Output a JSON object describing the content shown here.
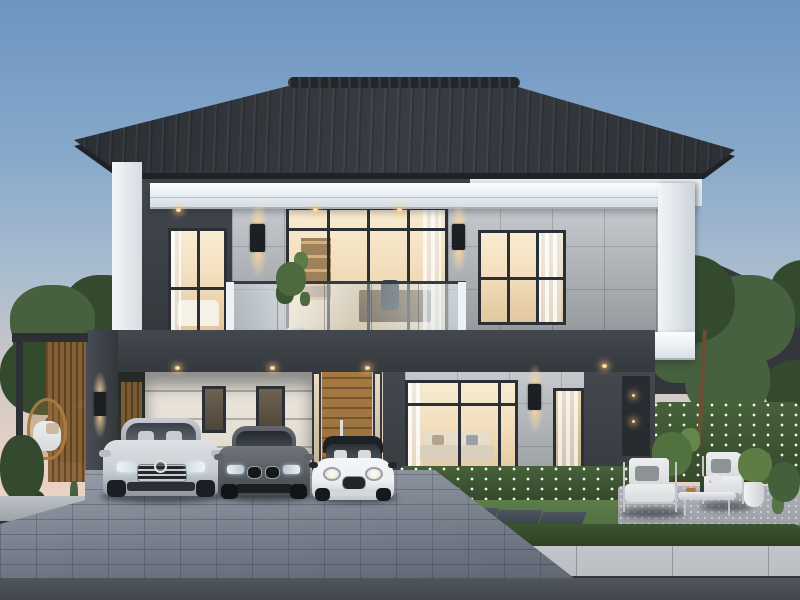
{
  "palette": {
    "sky_top": "#6d95c1",
    "sky_horizon": "#e8d1c3",
    "roof": "#383d43",
    "charcoal": "#43484e",
    "charcoal_dark": "#35393e",
    "white_band": "#e9eff3",
    "stone": "#b7bcc1",
    "stone_dark": "#a6abb0",
    "cream": "#ece7de",
    "frame": "#2b3036",
    "glass_warm": "#f3dfbe",
    "light_warm": "#ffd9a2",
    "wood": "#9a6e42",
    "tree": "#47603f",
    "tree_dark": "#344a2e",
    "hedge": "#46613a",
    "lawn": "#5f7f4a",
    "paver": "#8d95a2",
    "walk": "#b9bec3",
    "road": "#51555c",
    "rattan": "#a97a3e",
    "car_silver": "#c9ced4",
    "car_graphite": "#585c61",
    "car_white": "#edeff1"
  },
  "scene": {
    "time_of_day": "dusk",
    "subject": "modern two-storey detached house, front elevation rendering",
    "roof": "charcoal tiled hip roof with white fascia bands",
    "second_floor": {
      "left_window": "warm-lit bedroom window",
      "center": "balcony with glass railing and dark-framed sliding doors",
      "right_window": "warm-lit room window with curtain",
      "wall_sconces": 2,
      "balcony_plant": 1,
      "soffit_downlights": 3
    },
    "first_floor": {
      "carport": "charcoal-framed carport with cream lined wall and two small windows",
      "entrance": "timber slat door with glass sidelights",
      "living_room_window": "large warm-lit window with sofa visible",
      "secondary_window": "curtained warm-lit window",
      "wall_sconces": 2,
      "soffit_downlights": 4
    },
    "vehicles": [
      {
        "name": "silver luxury sedan",
        "position": "left carport bay"
      },
      {
        "name": "graphite sports sedan",
        "position": "middle carport bay"
      },
      {
        "name": "white compact with black roof",
        "position": "right carport bay"
      }
    ],
    "left_yard": {
      "hanging_egg_chair": 1,
      "timber_slat_screen": 1,
      "shrubs": true
    },
    "right_yard": {
      "patio_armchairs": 2,
      "coffee_table": 1,
      "planter_pots": 2,
      "stepping_stones": 4,
      "flower_hedge": true,
      "lawn": true
    },
    "street": {
      "paver_driveway": true,
      "concrete_sidewalk": true,
      "asphalt_road": true
    },
    "background": {
      "neighbour_roofs": 2,
      "trees_both_sides": true
    }
  }
}
